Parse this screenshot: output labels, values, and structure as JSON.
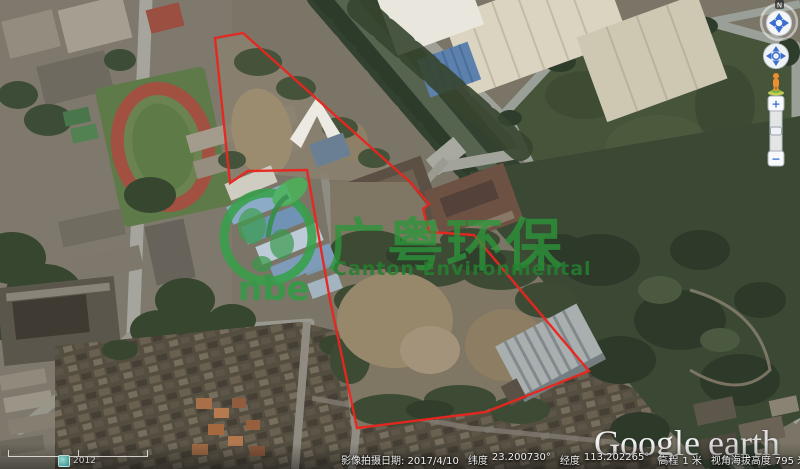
{
  "app_window": {
    "title": "Google Earth"
  },
  "colors": {
    "boundary_red": "#e8251f",
    "watermark_green": "#2f9e45",
    "canal_water": "#55634f"
  },
  "watermark": {
    "cn_text": "广粤环保",
    "en_text": "Canton Environmental",
    "logo_text": "nbe"
  },
  "branding": {
    "google": "Google",
    "earth": "earth"
  },
  "nav": {
    "north_label": "N",
    "zoom_in_label": "+",
    "zoom_out_label": "−"
  },
  "status_bar": {
    "history_year": "2012",
    "imagery_date": "影像拍摄日期: 2017/4/10",
    "lat_label": "纬度",
    "lat_value": "23.200730°",
    "lon_label": "经度",
    "lon_value": "113.202265°",
    "elev_label": "高程",
    "elev_value": "1 米",
    "eye_alt_label": "视角海拔高度",
    "eye_alt_value": "795 米"
  }
}
